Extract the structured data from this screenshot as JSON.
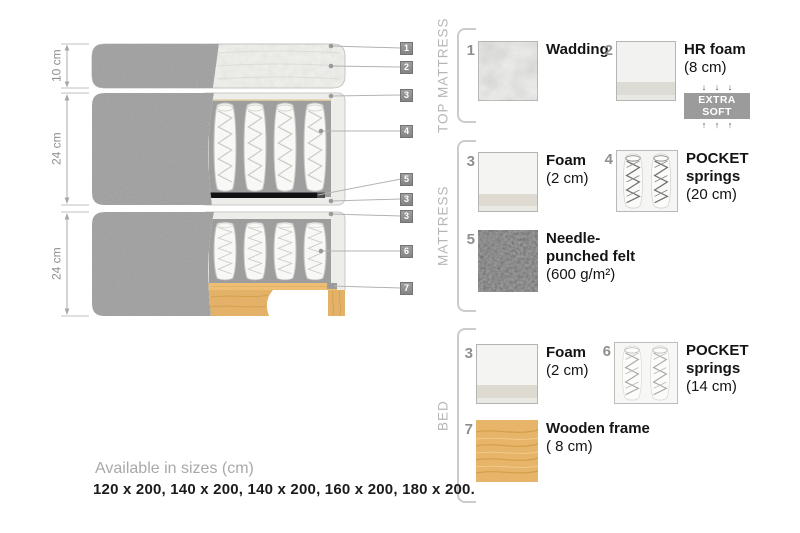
{
  "diagram": {
    "dims": [
      "10 cm",
      "24 cm",
      "24 cm"
    ],
    "callouts": [
      "1",
      "2",
      "3",
      "4",
      "5",
      "3",
      "3",
      "6",
      "7"
    ]
  },
  "legend": {
    "sections": [
      {
        "label": "TOP MATTRESS"
      },
      {
        "label": "MATTRESS"
      },
      {
        "label": "BED"
      }
    ],
    "items": [
      {
        "num": "1",
        "name": "Wadding",
        "detail": ""
      },
      {
        "num": "2",
        "name": "HR foam",
        "detail": "(8 cm)",
        "arrows_down": "↓ ↓ ↓",
        "badge": "EXTRA SOFT",
        "arrows_up": "↑ ↑ ↑"
      },
      {
        "num": "3",
        "name": "Foam",
        "detail": "(2 cm)"
      },
      {
        "num": "4",
        "name": "POCKET springs",
        "detail": "(20 cm)"
      },
      {
        "num": "5",
        "name": "Needle-punched felt",
        "detail": "(600 g/m²)"
      },
      {
        "num": "3",
        "name": "Foam",
        "detail": "(2 cm)"
      },
      {
        "num": "6",
        "name": "POCKET springs",
        "detail": "(14 cm)"
      },
      {
        "num": "7",
        "name": "Wooden frame",
        "detail": "( 8 cm)"
      }
    ]
  },
  "footer": {
    "title": "Available in sizes (cm)",
    "sizes": "120 x 200, 140 x 200, 140 x 200, 160 x 200, 180 x 200."
  },
  "palette": {
    "fabric_gray": "#ababab",
    "wood": "#e3b268",
    "badge_gray": "#9b9b9b",
    "felt_dark": "#121212"
  }
}
